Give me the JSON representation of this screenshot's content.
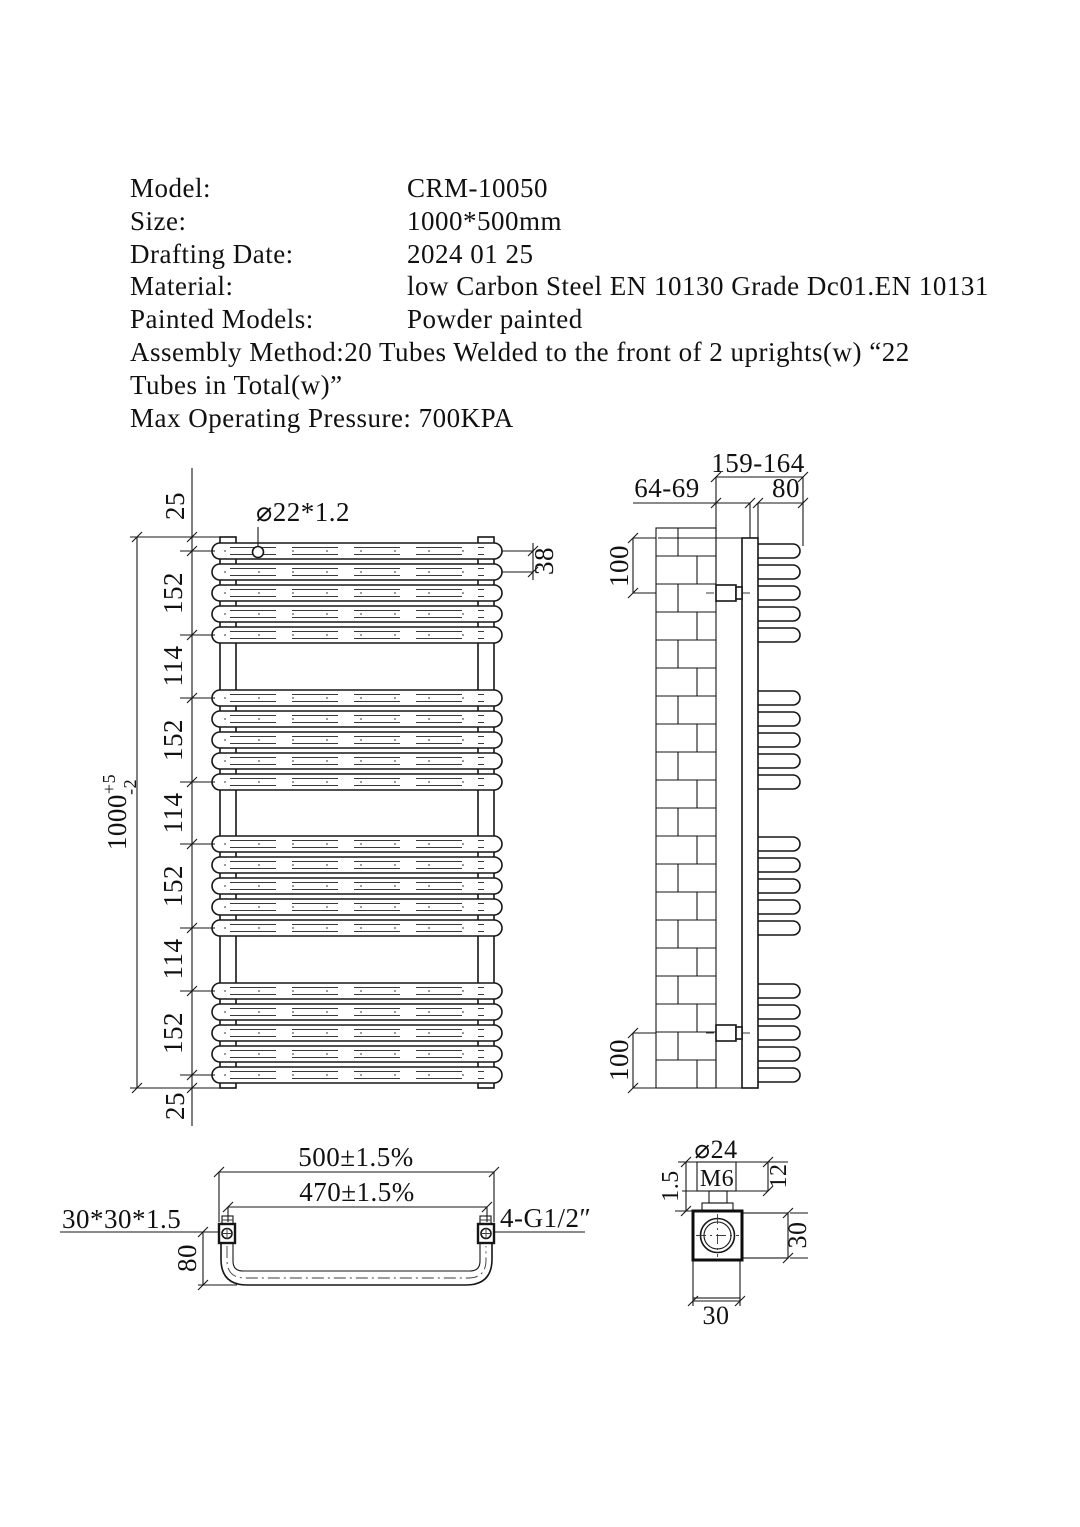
{
  "header": {
    "rows": [
      {
        "label": "Model:",
        "value": "CRM-10050"
      },
      {
        "label": "Size:",
        "value": "1000*500mm"
      },
      {
        "label": "Drafting Date:",
        "value": "2024 01 25"
      },
      {
        "label": "Material:",
        "value": "low Carbon Steel EN 10130 Grade Dc01.EN 10131"
      },
      {
        "label": "Painted Models:",
        "value": "Powder painted"
      }
    ],
    "assembly_line_1": "Assembly Method:20 Tubes Welded to the front of 2 uprights(w) “22",
    "assembly_line_2": "Tubes in Total(w)”",
    "pressure_line": "Max Operating Pressure: 700KPA"
  },
  "front_view": {
    "tube_spec": "⌀22*1.2",
    "tube_pitch": "38",
    "overall": {
      "value": "1000",
      "plus": "+5",
      "minus": "-2"
    },
    "chain": [
      "25",
      "152",
      "114",
      "152",
      "114",
      "152",
      "114",
      "152",
      "25"
    ],
    "tube_rows": [
      551,
      572,
      593,
      614,
      635,
      698,
      719,
      740,
      761,
      782,
      844,
      865,
      886,
      907,
      928,
      991,
      1012,
      1033,
      1054,
      1075
    ]
  },
  "side_view": {
    "depth_overall": "159-164",
    "wall_clearance": "64-69",
    "tube_depth": "80",
    "bracket_offset_top": "100",
    "bracket_offset_bottom": "100",
    "bolt_row_indices": [
      2,
      17
    ],
    "wall": {
      "x": 656,
      "w": 60,
      "y": 528,
      "h": 560,
      "course": 28,
      "joints": [
        678,
        697
      ]
    }
  },
  "bottom_view": {
    "overall_width": "500±1.5%",
    "centers_width": "470±1.5%",
    "upright_spec": "30*30*1.5",
    "connection_spec": "4-G1/2″",
    "depth": "80"
  },
  "detail_view": {
    "cap_diameter": "⌀24",
    "thread": "M6",
    "thickness": "1.5",
    "cap_height": "12",
    "block_height": "30",
    "block_width": "30"
  }
}
